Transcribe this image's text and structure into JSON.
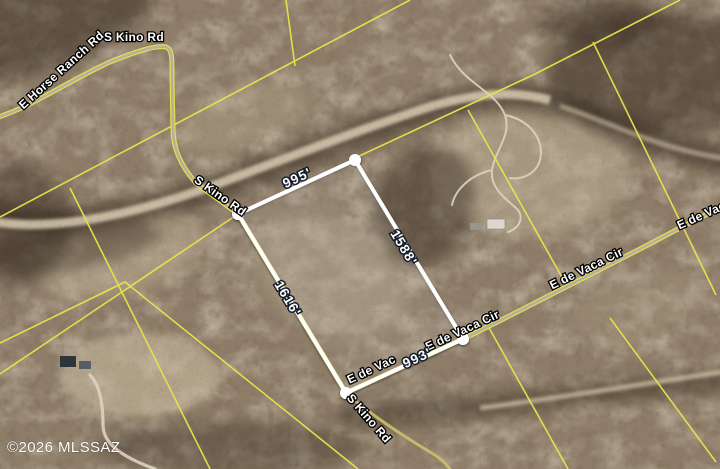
{
  "map": {
    "view": "satellite-parcel-overlay",
    "attribution": "©2026 MLSSAZ",
    "road_labels": [
      {
        "name": "e-horse-ranch-rd",
        "text": "E Horse Ranch Rd"
      },
      {
        "name": "s-kino-rd-top",
        "text": "S Kino Rd"
      },
      {
        "name": "s-kino-rd-mid",
        "text": "S Kino Rd"
      },
      {
        "name": "s-kino-rd-bottom",
        "text": "S Kino Rd"
      },
      {
        "name": "e-de-vaca-cir-near-parcel",
        "text": "E de Vaca Cir"
      },
      {
        "name": "e-de-vaca-cir-east",
        "text": "E de Vaca Cir"
      },
      {
        "name": "e-de-vaca-clipped-right-edge",
        "text": "E de Vac"
      },
      {
        "name": "e-de-vaca-clipped-south-edge",
        "text": "E de Vac"
      }
    ],
    "parcel": {
      "edge_labels": [
        {
          "edge": "north",
          "text": "995'"
        },
        {
          "edge": "east",
          "text": "1588'"
        },
        {
          "edge": "west",
          "text": "1616'"
        },
        {
          "edge": "south",
          "text": "993'"
        }
      ]
    },
    "colors": {
      "parcel_boundary": "#ffffff",
      "cadastral_line": "#e8e44a",
      "road_fill": "#b7afa2",
      "road_edge": "#e8e44a",
      "terrain_base": "#8d7d69",
      "wash_light": "#d8ccb2",
      "vegetation_dark": "#32261a",
      "label_fill": "#ffffff",
      "label_outline": "#000000",
      "measure_outline": "#141e2b"
    }
  }
}
